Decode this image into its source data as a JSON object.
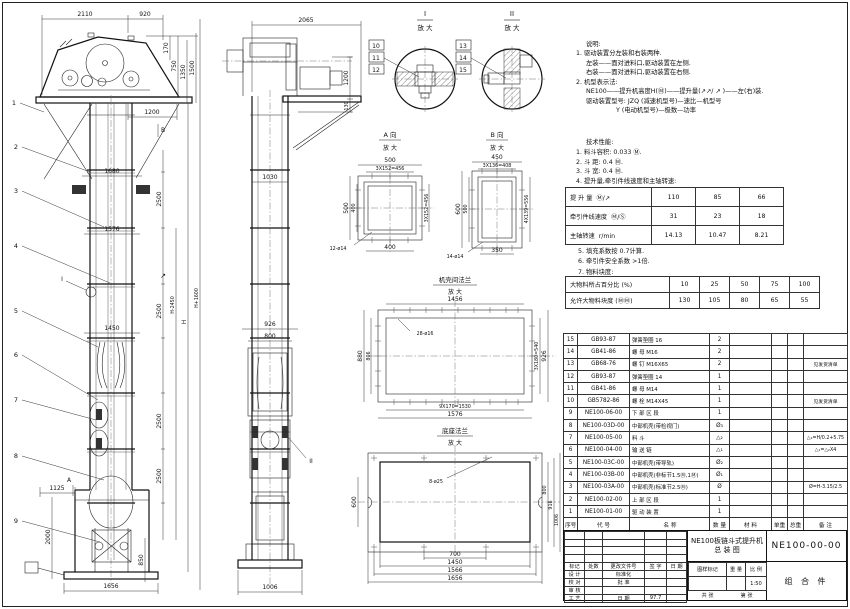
{
  "sheet": {
    "title": "NE100板链斗式提升机",
    "subtitle": "总  装  图",
    "drawing_no": "NE100-00-00",
    "part_class": "组 合 件"
  },
  "notes": {
    "heading": "说明:",
    "lines": [
      "1. 驱动装置分左装和右装两种.",
      "左装——面对进料口,驱动装置在左侧.",
      "右装——面对进料口,驱动装置在右侧.",
      "2. 机型表示法:",
      "NE100——提升机高度H(Ⓜ)——提升量(↗↗/ ↗ )——左(右)装.",
      "驱动装置型号: JZQ (减速机型号)—速比—机型号",
      "Y (电动机型号)—极数—功率"
    ]
  },
  "perf": {
    "heading": "技术性能:",
    "lines": [
      "1. 料斗容积: 0.033 Ⓜ.",
      "2. 斗  距: 0.4 Ⓜ.",
      "3. 斗  宽: 0.4 Ⓜ.",
      "4. 提升量,牵引件线速度和主轴转速:"
    ],
    "after": [
      "5. 填充系数按 0.7计算.",
      "6. 牵引件安全系数 >1倍.",
      "7. 物料块度:"
    ]
  },
  "speed_table": {
    "rows": [
      {
        "label": "提 升 量",
        "unit": "Ⓜ/↗",
        "v": [
          "110",
          "85",
          "66"
        ]
      },
      {
        "label": "牵引件线速度",
        "unit": "Ⓜ/Ⓢ",
        "v": [
          "31",
          "23",
          "18"
        ]
      },
      {
        "label": "主轴转速",
        "unit": "r/min",
        "v": [
          "14.13",
          "10.47",
          "8.21"
        ]
      }
    ]
  },
  "lump_table": {
    "rows": [
      {
        "label": "大物料所占百分比 (%)",
        "v": [
          "10",
          "25",
          "50",
          "75",
          "100"
        ]
      },
      {
        "label": "允许大物料块度 (ⓂⓂ)",
        "v": [
          "130",
          "105",
          "80",
          "65",
          "55"
        ]
      }
    ]
  },
  "bom": {
    "rows": [
      [
        "15",
        "GB93-87",
        "弹簧垫圈 16",
        "2",
        "",
        "",
        "",
        ""
      ],
      [
        "14",
        "GB41-86",
        "螺 母 M16",
        "2",
        "",
        "",
        "",
        ""
      ],
      [
        "13",
        "GB68-76",
        "螺 钉 M16X65",
        "2",
        "",
        "",
        "",
        "见发货清单"
      ],
      [
        "12",
        "GB93-87",
        "弹簧垫圈 14",
        "1",
        "",
        "",
        "",
        ""
      ],
      [
        "11",
        "GB41-86",
        "螺 母 M14",
        "1",
        "",
        "",
        "",
        ""
      ],
      [
        "10",
        "GB5782-86",
        "螺 栓 M14X45",
        "1",
        "",
        "",
        "",
        "见发货清单"
      ],
      [
        "9",
        "NE100-06-00",
        "下 部 区 段",
        "1",
        "",
        "",
        "",
        ""
      ],
      [
        "8",
        "NE100-03D-00",
        "中部机壳(带检视门)",
        "Ø₃",
        "",
        "",
        "",
        ""
      ],
      [
        "7",
        "NE100-05-00",
        "料 斗",
        "△₂",
        "",
        "",
        "",
        "△₂=H/0.2+5.75"
      ],
      [
        "6",
        "NE100-04-00",
        "输 送 链",
        "△₁",
        "",
        "",
        "",
        "△₁=△₂X4"
      ],
      [
        "5",
        "NE100-03C-00",
        "中部机壳(带导轨)",
        "Ø₂",
        "",
        "",
        "",
        ""
      ],
      [
        "4",
        "NE100-03B-00",
        "中部机壳(非标节1.5Ⓜ,1Ⓜ)",
        "Ø₁",
        "",
        "",
        "",
        ""
      ],
      [
        "3",
        "NE100-03A-00",
        "中部机壳(标准节2.5Ⓜ)",
        "Ø",
        "",
        "",
        "",
        "Ø=H-3.15/2.5"
      ],
      [
        "2",
        "NE100-02-00",
        "上 部 区 段",
        "1",
        "",
        "",
        "",
        ""
      ],
      [
        "1",
        "NE100-01-00",
        "驱 动 装 置",
        "1",
        "",
        "",
        "",
        ""
      ],
      [
        "序号",
        "代  号",
        "名  称",
        "数 量",
        "材  料",
        "单重",
        "总重",
        "备  注"
      ]
    ]
  },
  "title_block": {
    "left_rows": [
      [
        "",
        "",
        "",
        "",
        ""
      ],
      [
        "",
        "",
        "",
        "",
        ""
      ],
      [
        "",
        "",
        "",
        "",
        ""
      ],
      [
        "",
        "",
        "",
        "",
        ""
      ],
      [
        "标记",
        "处数",
        "更改文件号",
        "签 字",
        "日 期"
      ],
      [
        "设 计",
        "",
        "标准化",
        "",
        ""
      ],
      [
        "校 对",
        "",
        "批 准",
        "",
        ""
      ],
      [
        "审 核",
        "",
        "",
        "",
        ""
      ],
      [
        "工 艺",
        "",
        "日 期",
        "97.7",
        ""
      ]
    ],
    "stamp_rows": [
      [
        "图样标记",
        "重 量",
        "比 例"
      ],
      [
        "",
        "",
        "1:50"
      ]
    ],
    "sheet_total": "共  张",
    "sheet_no": "第  张"
  },
  "drawing": {
    "zoom_label": "放 大",
    "front": {
      "balloons": [
        "1",
        "2",
        "3",
        "4",
        "5",
        "6",
        "7",
        "8",
        "9"
      ],
      "d2110": "2110",
      "d920": "920",
      "d170": "170",
      "d750": "750",
      "d1350": "1350",
      "d1500": "1500",
      "d1200": "1200",
      "dB": "B",
      "d1680": "1680",
      "d2500": "2500",
      "d1576": "1576",
      "d1450": "1450",
      "dH2450": "H-2450",
      "dH": "H",
      "dH1600": "H+1600",
      "dI": "I",
      "dArrow": "↗",
      "dA": "A",
      "d1125": "1125",
      "d2000": "2000",
      "d850": "850",
      "d1656": "1656"
    },
    "side": {
      "d2065": "2065",
      "d1200": "1200",
      "d130": "130",
      "d1030": "1030",
      "d926": "926",
      "d800": "800",
      "d1006": "1006",
      "dII": "II"
    },
    "detail_i": {
      "title": "I",
      "b": [
        "10",
        "11",
        "12"
      ]
    },
    "detail_ii": {
      "title": "II",
      "b": [
        "13",
        "14",
        "15"
      ]
    },
    "detail_a": {
      "title": "A 向",
      "d500": "500",
      "d3x152": "3X152=456",
      "d400": "400",
      "holes": "12-ø14"
    },
    "detail_b": {
      "title": "B 向",
      "d450": "450",
      "d3x136": "3X136=408",
      "d600": "600",
      "d500": "500",
      "d4x139": "4X139=556",
      "d350": "350",
      "holes": "14-ø14"
    },
    "detail_flange": {
      "title": "机壳间法兰",
      "d1456": "1456",
      "holes": "28-ø16",
      "d880": "880",
      "d806": "806",
      "d3x180": "3X180=540",
      "d926": "926",
      "d9x170": "9X170=1530",
      "d1576": "1576"
    },
    "detail_base": {
      "title": "底座法兰",
      "holes": "8-ø25",
      "d600": "600",
      "d800": "800",
      "d916": "916",
      "d1006": "1006",
      "d700": "700",
      "d1450": "1450",
      "d1566": "1566",
      "d1656": "1656"
    }
  }
}
